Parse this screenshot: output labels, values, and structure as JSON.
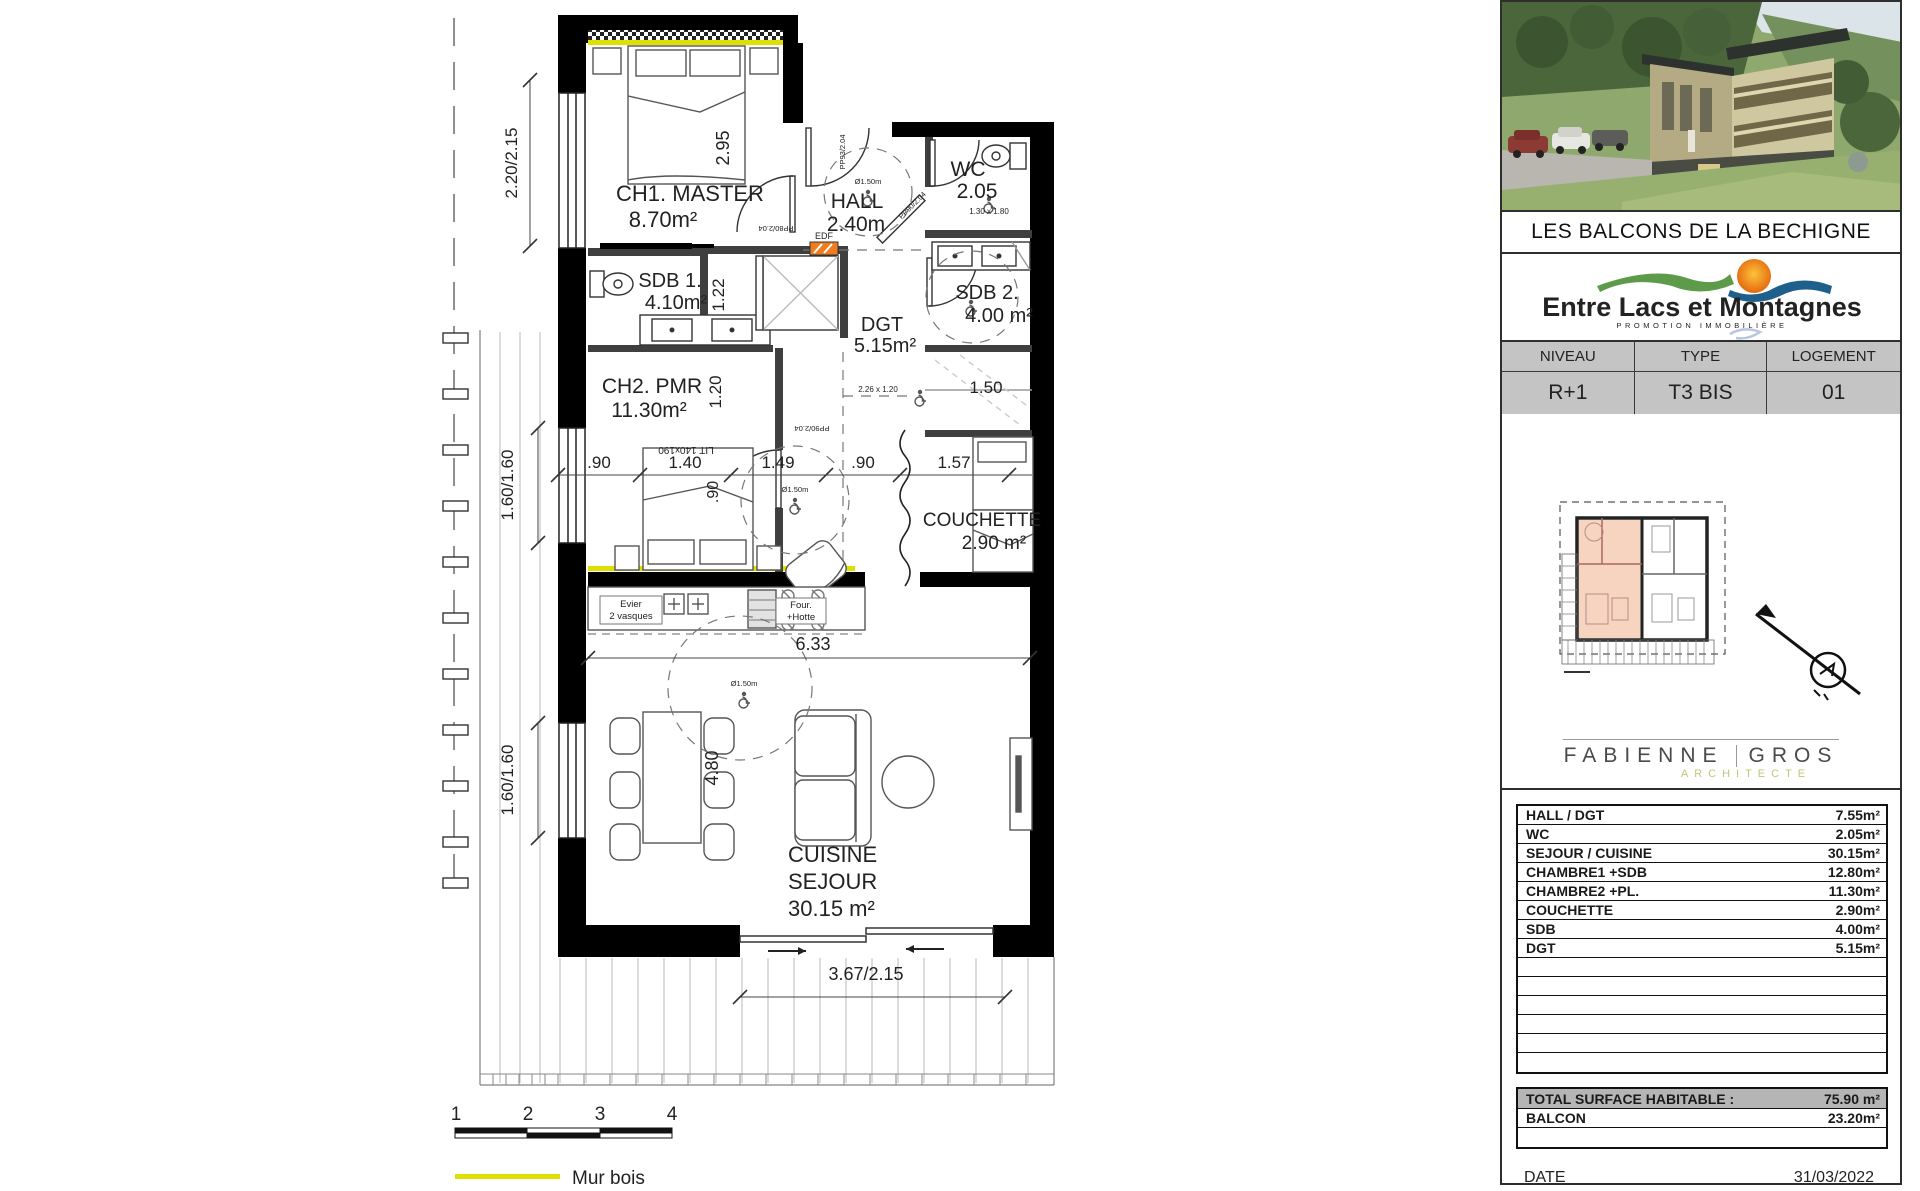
{
  "panel": {
    "title": "LES BALCONS DE LA BECHIGNE",
    "logo": {
      "name": "Entre Lacs et Montagnes",
      "tagline": "PROMOTION IMMOBILIÈRE"
    },
    "meta": {
      "headers": [
        "NIVEAU",
        "TYPE",
        "LOGEMENT"
      ],
      "values": [
        "R+1",
        "T3 BIS",
        "01"
      ]
    },
    "architect": {
      "first": "FABIENNE",
      "last": "GROS",
      "role": "ARCHITECTE"
    },
    "areas_table": {
      "rows": [
        {
          "label": "HALL / DGT",
          "value": "7.55m²"
        },
        {
          "label": "WC",
          "value": "2.05m²"
        },
        {
          "label": "SEJOUR / CUISINE",
          "value": "30.15m²"
        },
        {
          "label": "CHAMBRE1 +SDB",
          "value": "12.80m²"
        },
        {
          "label": "CHAMBRE2 +PL.",
          "value": "11.30m²"
        },
        {
          "label": "COUCHETTE",
          "value": "2.90m²"
        },
        {
          "label": "SDB",
          "value": "4.00m²"
        },
        {
          "label": "DGT",
          "value": "5.15m²"
        }
      ]
    },
    "totals": {
      "total_label": "TOTAL SURFACE HABITABLE :",
      "total_value": "75.90 m²",
      "balcon_label": "BALCON",
      "balcon_value": "23.20m²"
    },
    "date": {
      "label": "DATE",
      "value": "31/03/2022"
    }
  },
  "plan": {
    "rooms": [
      {
        "name": "CH1. MASTER",
        "area": "8.70m²"
      },
      {
        "name": "HALL",
        "area": "2.40m"
      },
      {
        "name": "WC",
        "area": "2.05"
      },
      {
        "name": "SDB 1.",
        "area": "4.10m²"
      },
      {
        "name": "SDB 2.",
        "area": "4.00 m²"
      },
      {
        "name": "DGT",
        "area": "5.15m²"
      },
      {
        "name": "CH2. PMR",
        "area": "11.30m²"
      },
      {
        "name": "COUCHETTE",
        "area": "2.90 m²"
      },
      {
        "name_line1": "CUISINE",
        "name_line2": "SEJOUR",
        "area": "30.15 m²"
      }
    ],
    "dims": {
      "s220": "2.20/2.15",
      "s295": "2.95",
      "s122": "1.22",
      "s120": "1.20",
      "s090v": ".90",
      "s160a": "1.60/1.60",
      "s160b": "1.60/1.60",
      "chain0": ".90",
      "chain1": "1.40",
      "chain2": "1.49",
      "chain3": ".90",
      "chain4": "1.57",
      "s633": "6.33",
      "s480": "4.80",
      "s150": "1.50",
      "s367": "3.67/2.15"
    },
    "ann": {
      "edf": "EDF",
      "lit": "LIT 140x190",
      "evier1": "Evier",
      "evier2": "2 vasques",
      "four1": "Four.",
      "four2": "+Hotte",
      "wcdim": "1.30 x 1.80",
      "dgtdim": "2.26 x 1.20",
      "dia": "Ø1.50m",
      "pp80": "PP80/2.04",
      "pp93": "PP93/2.04",
      "pp90": "PP90/2.04"
    },
    "legend": {
      "n1": "1",
      "n2": "2",
      "n3": "3",
      "n4": "4",
      "mur": "Mur bois"
    }
  }
}
